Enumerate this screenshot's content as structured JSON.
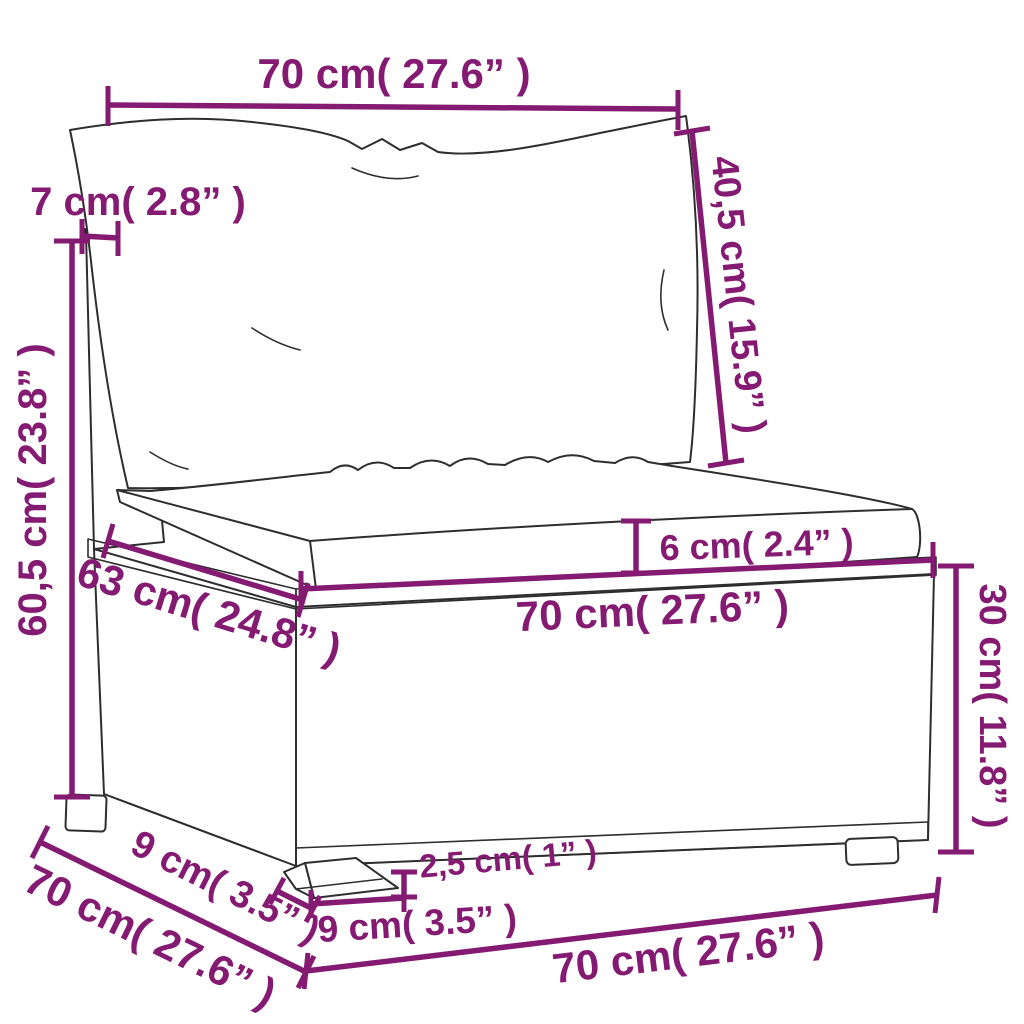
{
  "figure": {
    "description": "Dimension diagram of a poly rattan sectional middle sofa with back cushion and seat cushion"
  },
  "style": {
    "dimension_color": "#851a72",
    "line_color": "#2e2e2e",
    "background": "#ffffff"
  },
  "dimensions": {
    "back_cushion_width": {
      "label": "70 cm( 27.6” )"
    },
    "back_cushion_height": {
      "label": "40,5 cm( 15.9” )"
    },
    "back_frame_thickness": {
      "label": "7 cm( 2.8” )"
    },
    "total_height": {
      "label": "60,5 cm( 23.8” )"
    },
    "seat_depth": {
      "label": "63 cm( 24.8” )"
    },
    "seat_cushion_thickness": {
      "label": "6 cm( 2.4” )"
    },
    "seat_width": {
      "label": "70 cm( 27.6” )"
    },
    "base_height": {
      "label": "30 cm( 11.8” )"
    },
    "total_depth": {
      "label": "70 cm( 27.6” )"
    },
    "foot_depth": {
      "label": "9 cm( 3.5” )"
    },
    "foot_height": {
      "label": "2,5 cm( 1” )"
    },
    "foot_width": {
      "label": "9 cm( 3.5” )"
    },
    "total_width": {
      "label": "70 cm( 27.6” )"
    }
  }
}
